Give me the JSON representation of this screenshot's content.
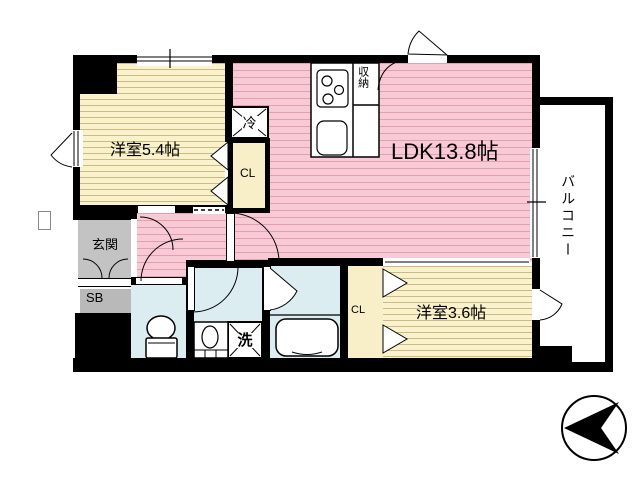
{
  "diagram_type": "apartment-floor-plan",
  "labels": {
    "ldk": "LDK13.8帖",
    "bedroom_a": "洋室5.4帖",
    "bedroom_b": "洋室3.6帖",
    "entrance": "玄関",
    "shoe_box": "SB",
    "closet_a": "CL",
    "closet_b": "CL",
    "storage": "収納",
    "refrigerator": "冷",
    "washing_machine": "洗",
    "balcony": "バルコニー"
  },
  "colors": {
    "wall": "#000000",
    "room_yellow": "#FAF2CC",
    "room_yellow_hatch": "#A58C46",
    "ldk_pink": "#F8CAD6",
    "ldk_pink_hatch": "#D67892",
    "wet_area_blue": "#DCEDF2",
    "entrance_gray": "#C3C3C3",
    "closet_beige": "#F8EFC9",
    "background": "#FFFFFF"
  }
}
